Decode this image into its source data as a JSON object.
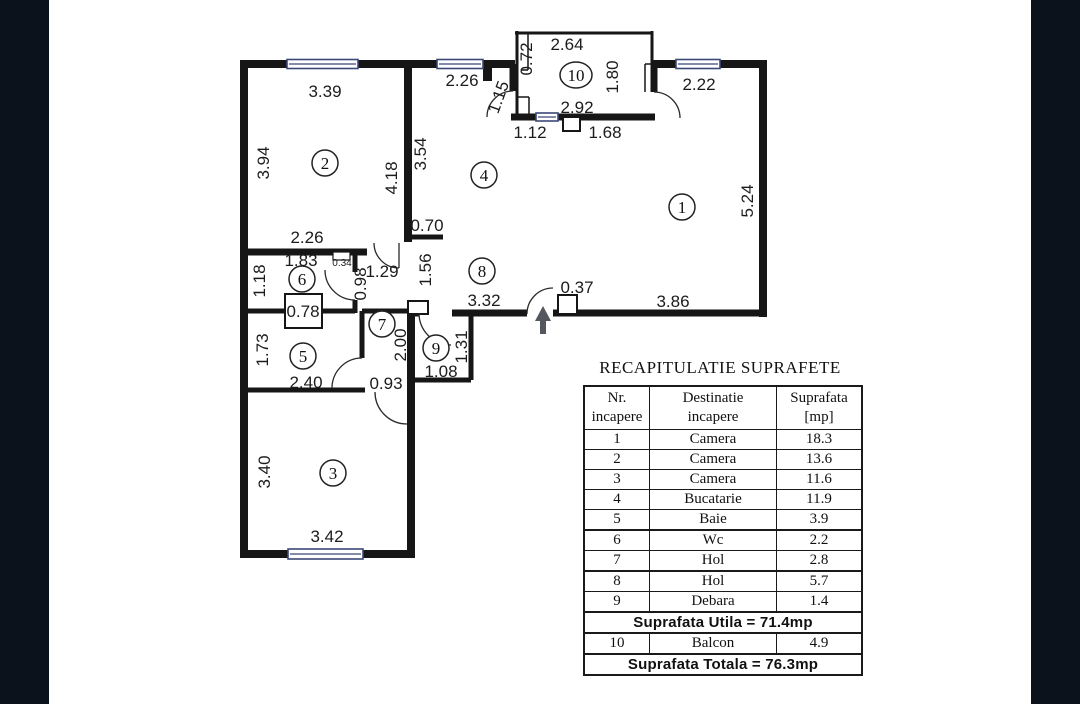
{
  "colors": {
    "band": "#0c121b",
    "paper": "#ffffff",
    "walls": "#161616",
    "window_lines": "#3c4877",
    "arrow": "#54575d"
  },
  "plan": {
    "room_labels": {
      "r1": "1",
      "r2": "2",
      "r3": "3",
      "r4": "4",
      "r5": "5",
      "r6": "6",
      "r7": "7",
      "r8": "8",
      "r9": "9",
      "r10": "10"
    },
    "dims": {
      "balcony_width_top": "2.64",
      "balcony_side_left": "0.72",
      "balcony_side_right": "1.80",
      "balcony_width_inner": "2.92",
      "balcony_bottom_left": "1.12",
      "balcony_bottom_right": "1.68",
      "balcony_door": "1.15",
      "kitchen_window_top": "2.26",
      "room1_top": "2.22",
      "room2_top": "3.39",
      "room2_left": "3.94",
      "room2_right": "4.18",
      "kitchen_left": "3.54",
      "room1_right": "5.24",
      "kitchen_stub": "0.70",
      "room2_bottom": "2.26",
      "wc_top": "1.83",
      "wc_niche": "0.34",
      "wc_left": "1.18",
      "wc_right": "0.98",
      "hall_door": "1.29",
      "hall_wall_left": "1.56",
      "hol8_width": "3.32",
      "entry_pillar": "0.37",
      "room1_bottom": "3.86",
      "shaft": "0.78",
      "bath_left": "1.73",
      "hall7_height": "2.00",
      "debara_right": "1.31",
      "debara_width": "1.08",
      "bath_bottom": "2.40",
      "room3_door": "0.93",
      "room3_left": "3.40",
      "room3_bottom": "3.42"
    }
  },
  "table": {
    "title": "RECAPITULATIE SUPRAFETE",
    "header": {
      "col1_line1": "Nr.",
      "col1_line2": "incapere",
      "col2_line1": "Destinatie",
      "col2_line2": "incapere",
      "col3_line1": "Suprafata",
      "col3_line2": "[mp]"
    },
    "rows": [
      {
        "nr": "1",
        "dest": "Camera",
        "mp": "18.3"
      },
      {
        "nr": "2",
        "dest": "Camera",
        "mp": "13.6"
      },
      {
        "nr": "3",
        "dest": "Camera",
        "mp": "11.6"
      },
      {
        "nr": "4",
        "dest": "Bucatarie",
        "mp": "11.9"
      },
      {
        "nr": "5",
        "dest": "Baie",
        "mp": "3.9"
      },
      {
        "nr": "6",
        "dest": "Wc",
        "mp": "2.2"
      },
      {
        "nr": "7",
        "dest": "Hol",
        "mp": "2.8"
      },
      {
        "nr": "8",
        "dest": "Hol",
        "mp": "5.7"
      },
      {
        "nr": "9",
        "dest": "Debara",
        "mp": "1.4"
      }
    ],
    "subtotal_label": "Suprafata Utila = 71.4mp",
    "balcony_row": {
      "nr": "10",
      "dest": "Balcon",
      "mp": "4.9"
    },
    "total_label": "Suprafata Totala = 76.3mp"
  }
}
